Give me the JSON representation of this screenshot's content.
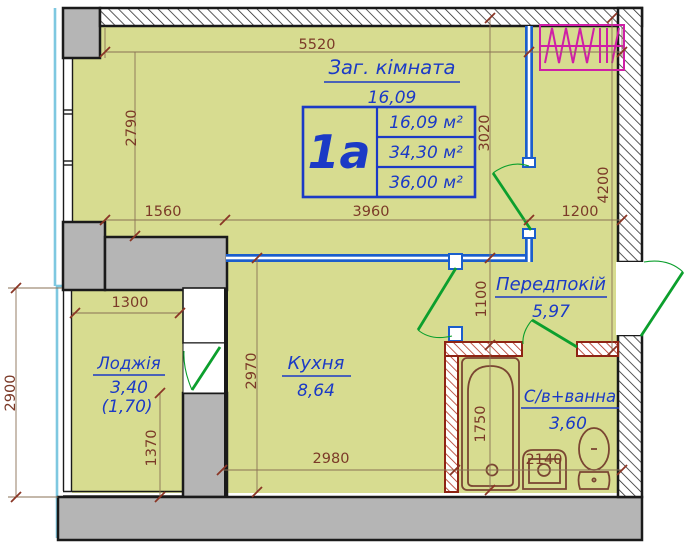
{
  "plan": {
    "unit": {
      "code": "1а",
      "living_area": "16,09 м²",
      "total_area": "34,30 м²",
      "overall_area": "36,00 м²"
    },
    "rooms": {
      "living": {
        "name": "Заг. кімната",
        "area": "16,09"
      },
      "kitchen": {
        "name": "Кухня",
        "area": "8,64"
      },
      "hall": {
        "name": "Передпокій",
        "area": "5,97"
      },
      "bath": {
        "name": "С/в+ванна",
        "area": "3,60"
      },
      "loggia": {
        "name": "Лоджія",
        "area": "3,40",
        "area_coeff": "(1,70)"
      }
    },
    "dims": {
      "d5520": "5520",
      "d2790": "2790",
      "d1560": "1560",
      "d3960": "3960",
      "d1200": "1200",
      "d3020": "3020",
      "d4200": "4200",
      "d1100": "1100",
      "d1300": "1300",
      "d2900": "2900",
      "d2970": "2970",
      "d1370": "1370",
      "d1750": "1750",
      "d2980": "2980",
      "d2140": "2140"
    },
    "colors": {
      "floor": "#d7dc90",
      "wall_gray": "#b5b5b5",
      "label_blue": "#1b3ac6",
      "dim_brown": "#7b3a28",
      "door_green": "#0c9f2d",
      "glazing_blue": "#7ec8e0",
      "partition_blue": "#1b5ecc",
      "brick_red": "#a3311b",
      "vent_magenta": "#cf1fa6"
    }
  }
}
